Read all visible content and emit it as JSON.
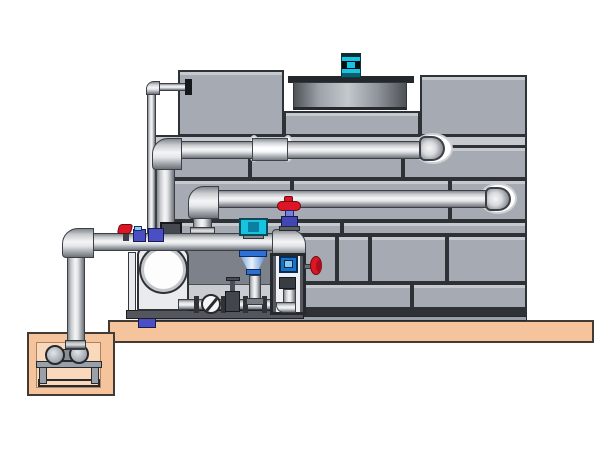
{
  "scene": {
    "type": "technical-illustration",
    "subject": "Closed-circuit cooling tower with fan motor, header piping, pump skid and sump pit",
    "text_content": "none"
  },
  "colors": {
    "bg": "#ffffff",
    "panel": "#a6abb3",
    "panel-light": "#c6cacf",
    "outline": "#2e3237",
    "shroud-dark": "#4e5257",
    "motor-cyan": "#14c6e4",
    "red": "#dd1626",
    "blue-valve": "#4a50c4",
    "strainer-blue": "#2d6fd2",
    "actuator-cyan": "#16c4e2",
    "frame-blue": "#1a73c4",
    "concrete": "#f5c49c",
    "concrete-light": "#fad8bb",
    "steel-dark": "#53575d",
    "skid-gray": "#7d828a",
    "pump-white": "#e9ebee"
  },
  "components": {
    "tower": {
      "label": "cooling tower casing with panel walls"
    },
    "fan_shroud": {
      "label": "fan shroud cylinder on tower roof"
    },
    "fan_motor": {
      "label": "cyan fan drive motor"
    },
    "vent_line": {
      "label": "small vent line down tower left side"
    },
    "upper_header": {
      "label": "upper horizontal header pipe with wall penetration"
    },
    "lower_header": {
      "label": "lower horizontal header pipe with wall penetration"
    },
    "suction_header": {
      "label": "pump suction header pipe"
    },
    "riser": {
      "label": "vertical riser pipe into sump pit"
    },
    "pump": {
      "label": "centrifugal pump with round inlet"
    },
    "actuated_valve": {
      "label": "cyan actuated control valve"
    },
    "strainer": {
      "label": "blue reducer strainer cone"
    },
    "gate_valve_red": {
      "label": "gate valve with red handwheel"
    },
    "butterfly_valve": {
      "label": "butterfly valve disc in bottom pipe train"
    },
    "instrument_frame": {
      "label": "instrument stand frame with gauge"
    },
    "red_handle": {
      "label": "red butterfly valve lever"
    },
    "platform": {
      "label": "concrete foundation slab"
    },
    "sump_pit": {
      "label": "concrete sump pit"
    },
    "sump_pump": {
      "label": "sump pump on steel stand"
    }
  }
}
